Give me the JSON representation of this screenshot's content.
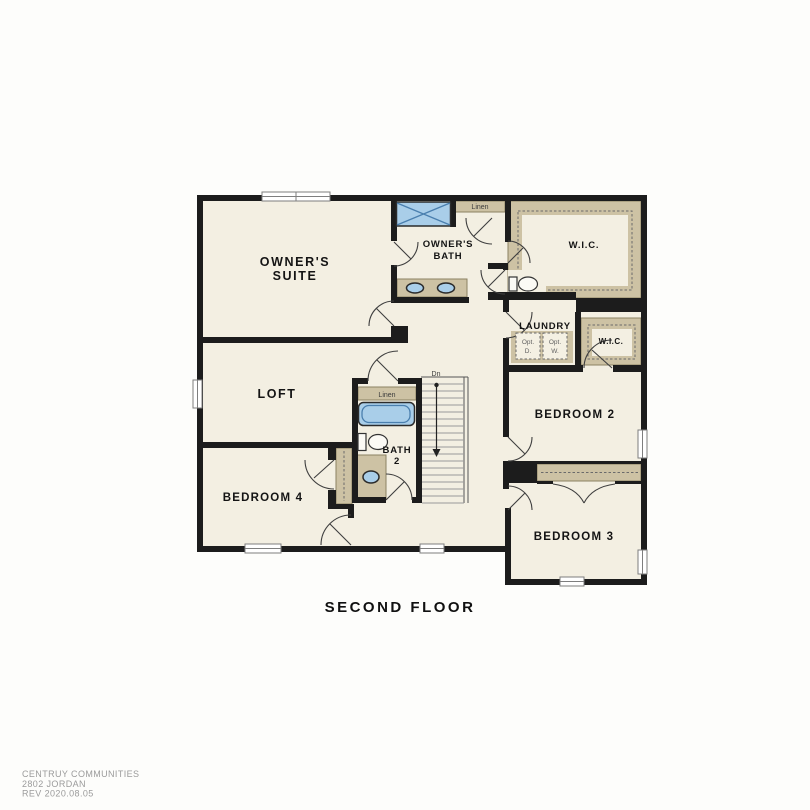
{
  "plan": {
    "title": "SECOND FLOOR",
    "rooms": [
      {
        "name": "owners-suite",
        "lines": [
          "OWNER'S",
          "SUITE"
        ]
      },
      {
        "name": "owners-bath",
        "lines": [
          "OWNER'S",
          "BATH"
        ]
      },
      {
        "name": "wic-owners",
        "lines": [
          "W.I.C."
        ]
      },
      {
        "name": "laundry",
        "lines": [
          "LAUNDRY"
        ]
      },
      {
        "name": "wic-hall",
        "lines": [
          "W.I.C."
        ]
      },
      {
        "name": "bedroom-2",
        "lines": [
          "BEDROOM 2"
        ]
      },
      {
        "name": "loft",
        "lines": [
          "LOFT"
        ]
      },
      {
        "name": "bath-2",
        "lines": [
          "BATH",
          "2"
        ]
      },
      {
        "name": "bedroom-4",
        "lines": [
          "BEDROOM 4"
        ]
      },
      {
        "name": "bedroom-3",
        "lines": [
          "BEDROOM 3"
        ]
      }
    ],
    "fixtures": {
      "linen_owners": "Linen",
      "linen_bath2": "Linen",
      "opt_dryer_line1": "Opt.",
      "opt_dryer_line2": "D.",
      "opt_washer_line1": "Opt.",
      "opt_washer_line2": "W.",
      "stair_direction": "Dn"
    }
  },
  "footer": {
    "lines": [
      "CENTRUY COMMUNITIES",
      "2802 JORDAN",
      "REV 2020.08.05"
    ]
  },
  "colors": {
    "wall": "#1c1c1c",
    "floor": "#f3efe2",
    "casework": "#cdc2a4",
    "casework_border": "#8b8162",
    "fixture_blue": "#a9cee9",
    "fixture_blue_dark": "#4a7fae",
    "label": "#141414",
    "footer_text": "#9b9b9b",
    "stair_tread": "#9a9a9a",
    "page_bg": "#fdfdfb"
  }
}
